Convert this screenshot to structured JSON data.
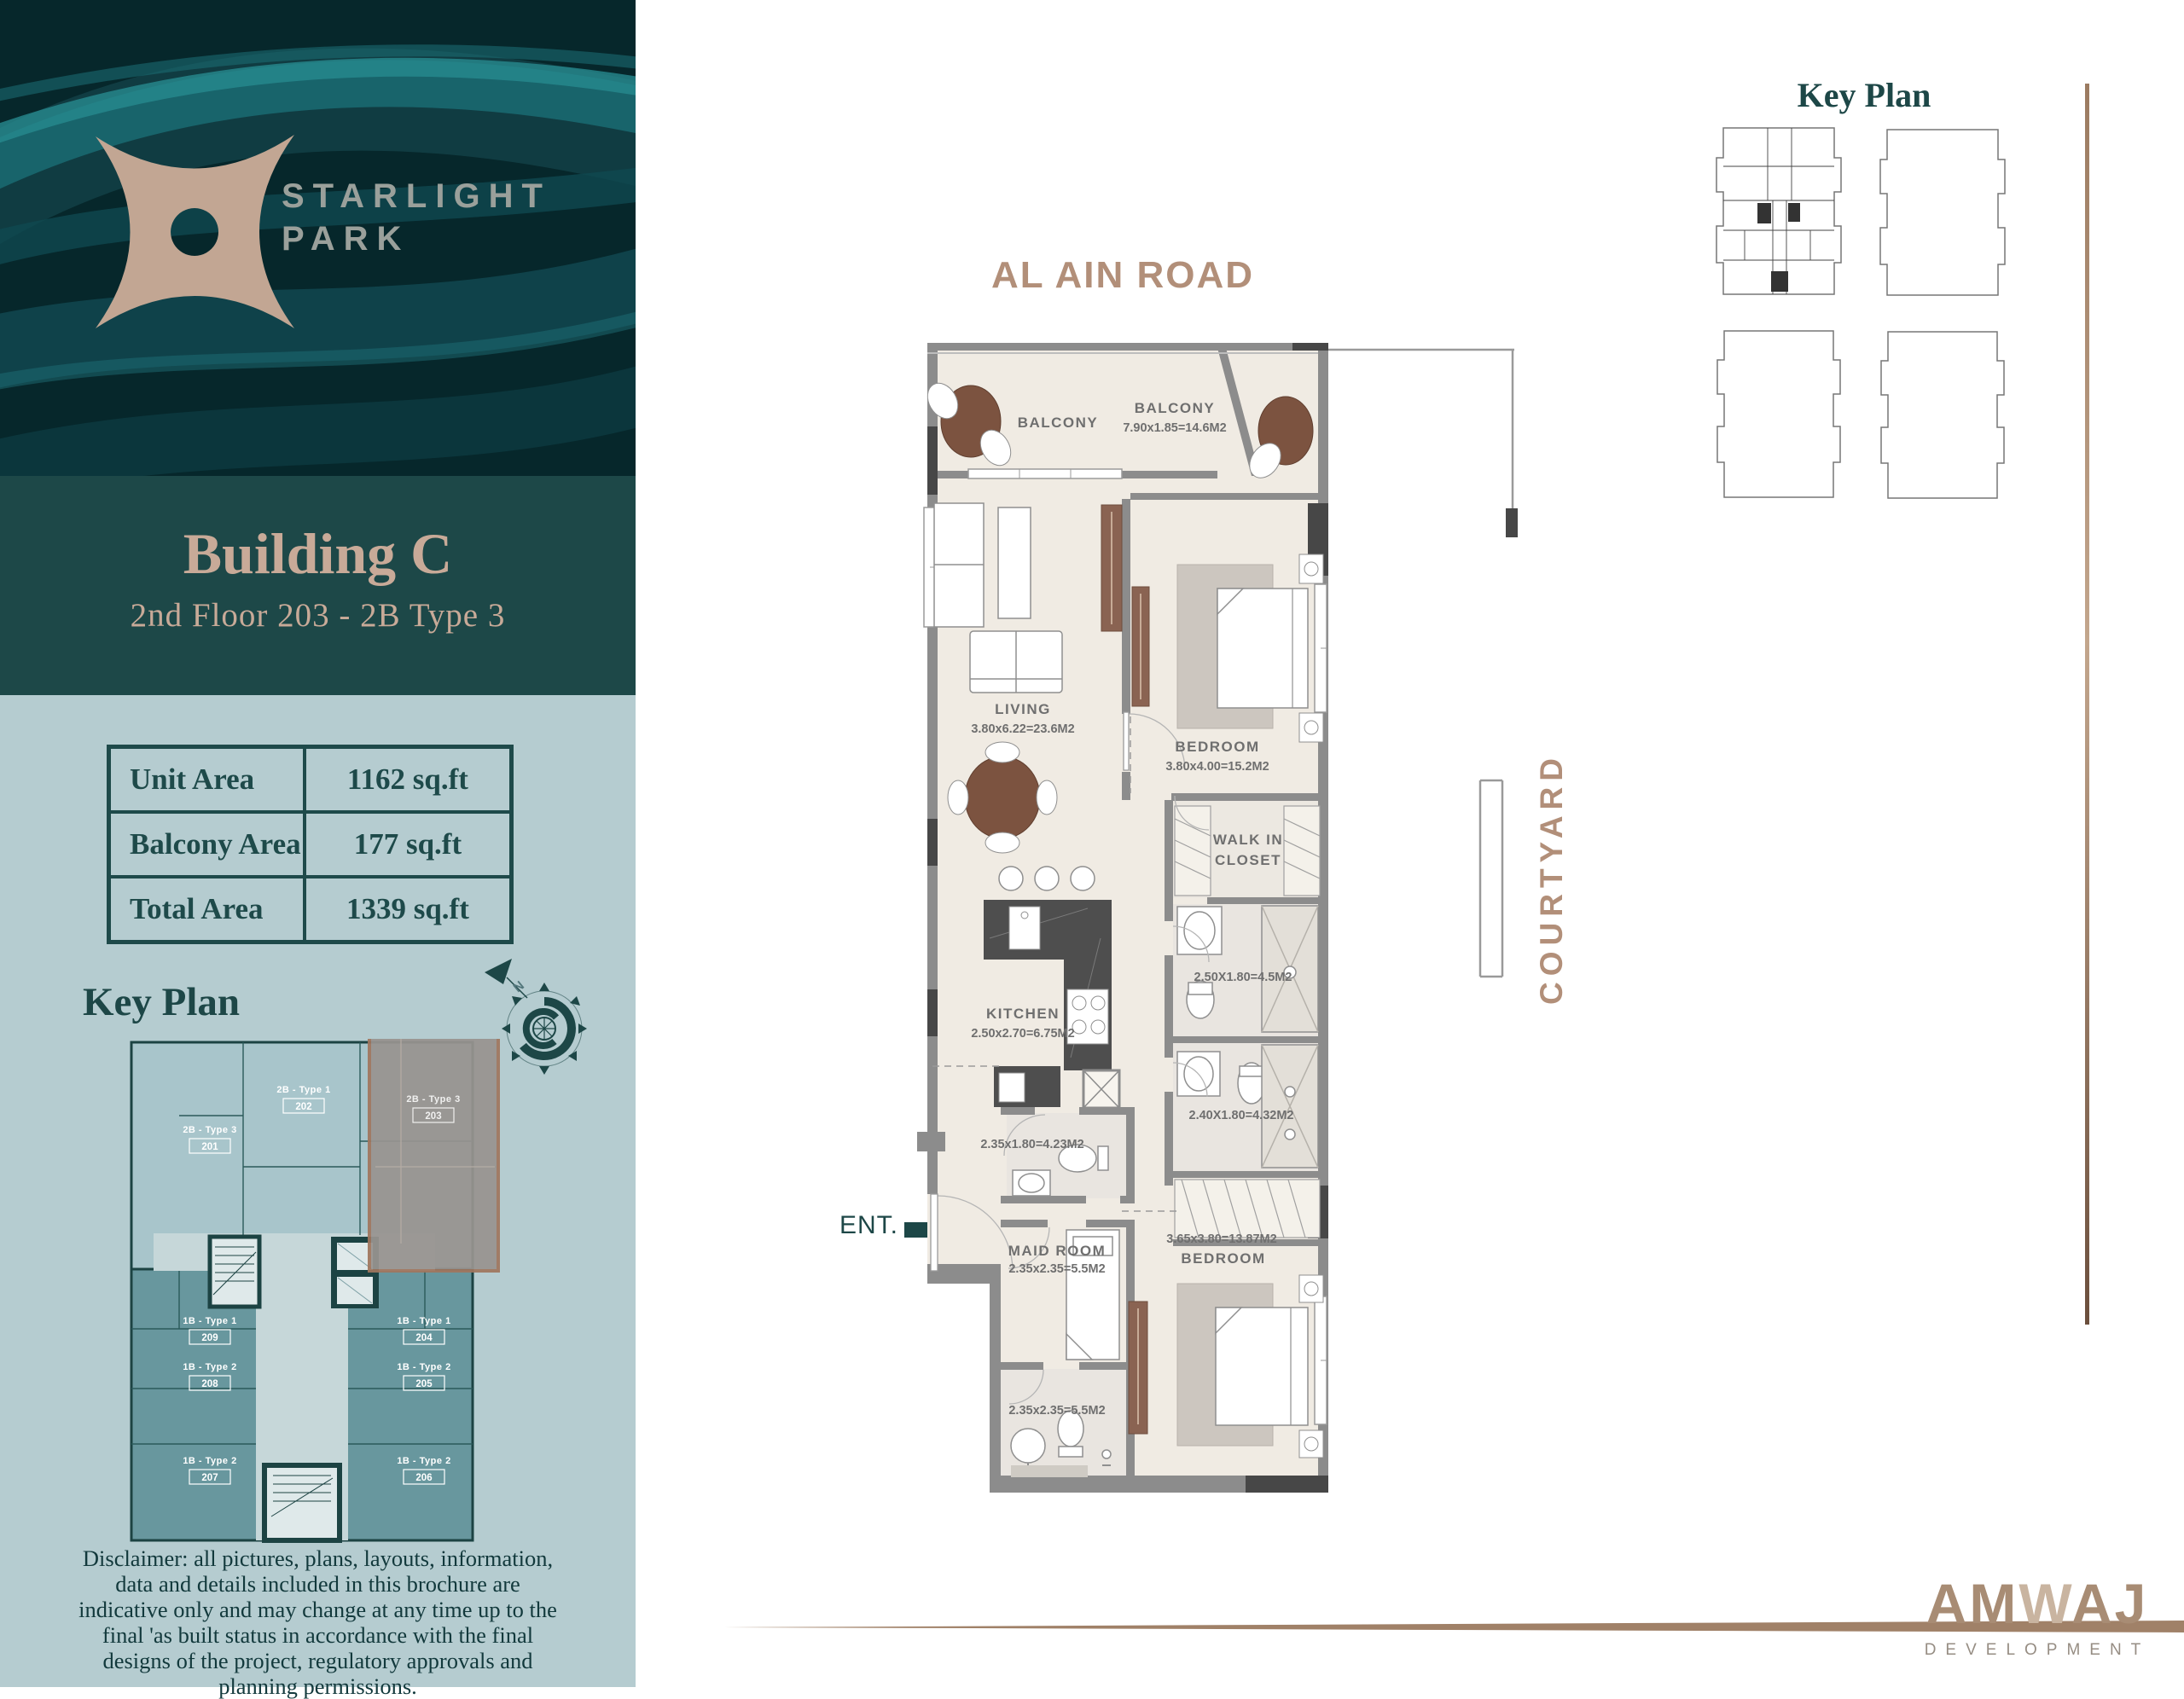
{
  "brand": {
    "name_line1": "STARLIGHT",
    "name_line2": "PARK",
    "building_title": "Building C",
    "building_subtitle": "2nd Floor 203 - 2B Type 3"
  },
  "area_table": {
    "rows": [
      {
        "label": "Unit Area",
        "value": "1162 sq.ft"
      },
      {
        "label": "Balcony Area",
        "value": "177 sq.ft"
      },
      {
        "label": "Total Area",
        "value": "1339 sq.ft"
      }
    ]
  },
  "key_plan_left": {
    "title": "Key Plan",
    "units": [
      {
        "type": "2B - Type 3",
        "number": "201"
      },
      {
        "type": "2B - Type 1",
        "number": "202"
      },
      {
        "type": "2B - Type 3",
        "number": "203"
      },
      {
        "type": "1B - Type 1",
        "number": "209"
      },
      {
        "type": "1B - Type 2",
        "number": "208"
      },
      {
        "type": "1B - Type 2",
        "number": "207"
      },
      {
        "type": "1B - Type 1",
        "number": "204"
      },
      {
        "type": "1B - Type 2",
        "number": "205"
      },
      {
        "type": "1B - Type 2",
        "number": "206"
      }
    ]
  },
  "disclaimer": "Disclaimer: all pictures, plans, layouts, information, data and details included in this brochure are indicative only and may change at any time up to the final 'as built status in accordance with the final designs of the project, regulatory approvals and planning permissions.",
  "floor_plan": {
    "road_label": "AL AIN ROAD",
    "courtyard_label": "COURTYARD",
    "entrance_label": "ENT.",
    "unit_number": "203",
    "compass_n": "N",
    "rooms": {
      "balcony_left": {
        "name": "BALCONY"
      },
      "balcony_right": {
        "name": "BALCONY",
        "dims": "7.90x1.85=14.6M2"
      },
      "living": {
        "name": "LIVING",
        "dims": "3.80x6.22=23.6M2"
      },
      "bedroom1": {
        "name": "BEDROOM",
        "dims": "3.80x4.00=15.2M2"
      },
      "walk_in_closet_line1": "WALK IN",
      "walk_in_closet_line2": "CLOSET",
      "bath1": {
        "dims": "2.50X1.80=4.5M2"
      },
      "bath2": {
        "dims": "2.40X1.80=4.32M2"
      },
      "kitchen": {
        "name": "KITCHEN",
        "dims": "2.50x2.70=6.75M2"
      },
      "bath3": {
        "dims": "2.35x1.80=4.23M2"
      },
      "maid_room": {
        "name": "MAID ROOM",
        "dims": "2.35x2.35=5.5M2"
      },
      "maid_bath": {
        "dims": "2.35x2.35=5.5M2"
      },
      "bedroom2": {
        "name": "BEDROOM",
        "dims": "3.65x3.80=13.87M2"
      }
    }
  },
  "key_plan_right": {
    "title": "Key Plan"
  },
  "developer": {
    "name_parts": [
      "AM",
      "W",
      "AJ"
    ],
    "tagline": "DEVELOPMENT"
  }
}
